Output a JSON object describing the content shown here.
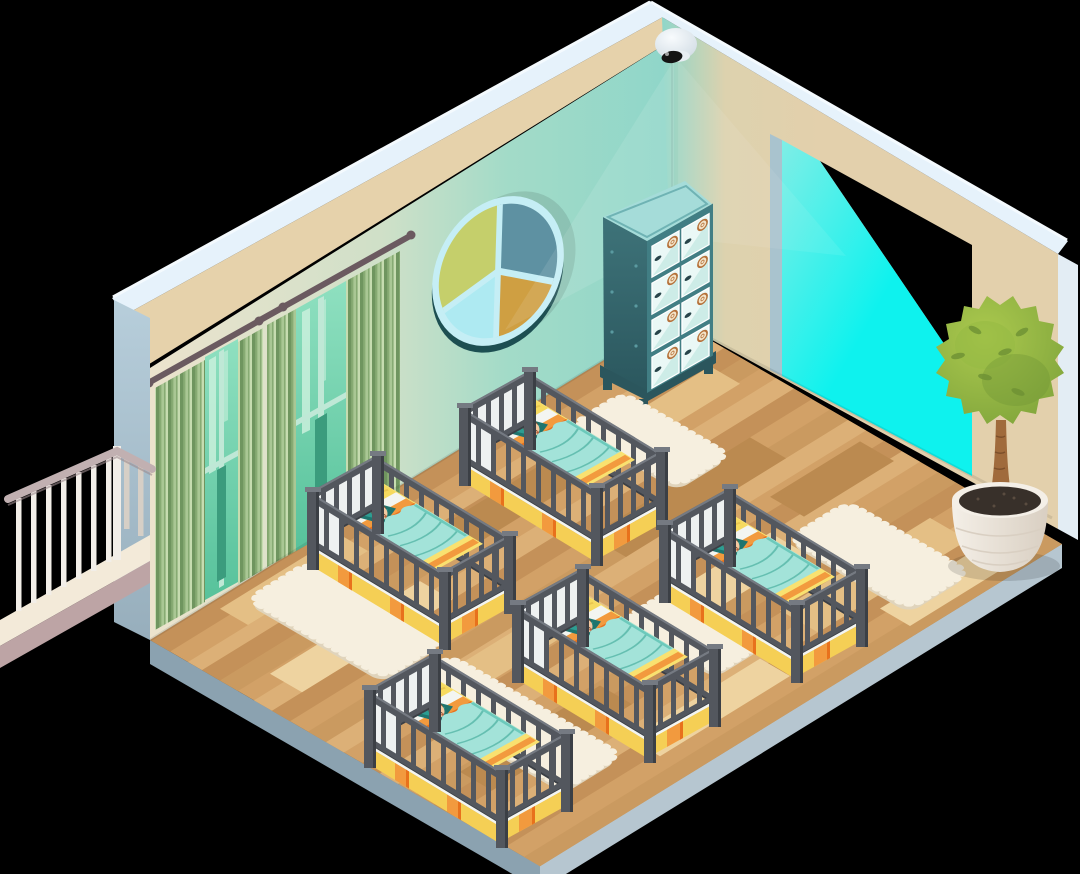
{
  "scene": {
    "description": "Isometric cutaway illustration of a nursery / daycare sleeping room",
    "objects": {
      "security_camera": 1,
      "camera_light_beams": 2,
      "round_pie_wall_window": 1,
      "pie_window_segments": 4,
      "curtained_windows": 2,
      "curtain_panels": 4,
      "locker_cabinet": {
        "count": 1,
        "door_rows": 4,
        "door_columns": 2,
        "doors": 8
      },
      "cribs": 5,
      "sleeping_babies": 5,
      "rugs": 5,
      "potted_topiary_plant": 1,
      "balcony_railing": 1,
      "walls": 2,
      "floor": "wood plank parquet"
    }
  },
  "colors": {
    "bg": "#000000",
    "roofIce": "#e6f2fb",
    "roofIceLight": "#f4fafe",
    "bandTan": "#e6d2ab",
    "wallCream": "#ece3cd",
    "wallCreamMid": "#cfe0c8",
    "wallTeal": "#a3dbc8",
    "wallTealDeep": "#8fd6c9",
    "wallBeigeR": "#e3d0ac",
    "wallBeigeMid": "#ddd2ae",
    "endFaceTop": "#b7cedb",
    "endFaceBot": "#97aebc",
    "endFaceR": "#e3edf4",
    "floorEdgeL": "#8ba2b0",
    "floorEdgeR": "#b6c6d0",
    "wood1": "#d2a167",
    "wood2": "#c49159",
    "wood3": "#dcb077",
    "wood4": "#ca9a60",
    "woodLight": "#e4bf85",
    "woodDark": "#bb8a50",
    "woodPale": "#eed3a0",
    "rug": "#f6efdf",
    "rugShade": "#e0d4bc",
    "cribFrame": "#53575e",
    "cribFrameTop": "#757a82",
    "cribFrameDark": "#3b3f45",
    "cribWhite": "#eef1f1",
    "mattYellow": "#f9e170",
    "mattYellowSide": "#f5cf55",
    "orange": "#f29a3e",
    "orangeDeep": "#e8711c",
    "pillowYellow": "#f6da5f",
    "pillowFold": "#e9c54e",
    "pillowTeal": "#2d9d92",
    "pillowTealDark": "#1f756e",
    "blanket": "#a3e3d9",
    "blanketShade": "#6cc9bb",
    "blanketLine": "#5bb8a9",
    "sheetWhite": "#f3f5f1",
    "skin": "#f4c9a1",
    "hair": "#6d4a2e",
    "mouth": "#b5623f",
    "curtain1": "#6f955f",
    "curtain2": "#a9c794",
    "curtain3": "#87ab73",
    "curtain4": "#c6dcb0",
    "rod": "#6b5a60",
    "glassTop": "#8fe0c0",
    "glassBot": "#57c29b",
    "glassStreak": "#c9f0dc",
    "mullion": "#3b9c7d",
    "mullionLight": "#bfe8d6",
    "winRim": "#c5eef5",
    "winRimDark": "#1d4f52",
    "segGreen": "#c5cf6b",
    "segSlate": "#5e91a2",
    "segAmber": "#cf9f42",
    "segCyan": "#aeeaf2",
    "lockerSideTop": "#3e7379",
    "lockerSideBot": "#2b575e",
    "lockerFront": "#417e84",
    "lockerTop": "#a5dcd9",
    "lockerTopEdge": "#6fb3b4",
    "lockerDoor": "#eaf8f6",
    "lockerDoorShade": "#cdece7",
    "lockerPlinth": "#2b565d",
    "badgeRing": "#b5713a",
    "badgeFill": "#f3e4c9",
    "handle": "#28444a",
    "rivet": "#5a9aa0",
    "cyanBright": "#0ef2ee",
    "cyanSoft": "#7feee6",
    "jamb": "#a9c3ce",
    "leafDark": "#7da23a",
    "leafMid": "#95b944",
    "leafLight": "#abc94e",
    "leafVein": "#6e9134",
    "trunk": "#a06b3c",
    "trunkDark": "#7c4f2a",
    "potWhite": "#f4efe7",
    "potShade": "#d9cfc2",
    "soil": "#38302a",
    "deck": "#f3ead9",
    "deckShade": "#e0d0c4",
    "deckEdge": "#bda4a5",
    "baluster": "#f2eee8",
    "balusterShade": "#d6cfc6",
    "handrail": "#c1b0b1",
    "handrailDark": "#9c8b8d",
    "domeWhite": "#f8fbfd",
    "domeShade": "#ccd8e1",
    "domeLip": "#e8eef3",
    "lens": "#141414"
  }
}
